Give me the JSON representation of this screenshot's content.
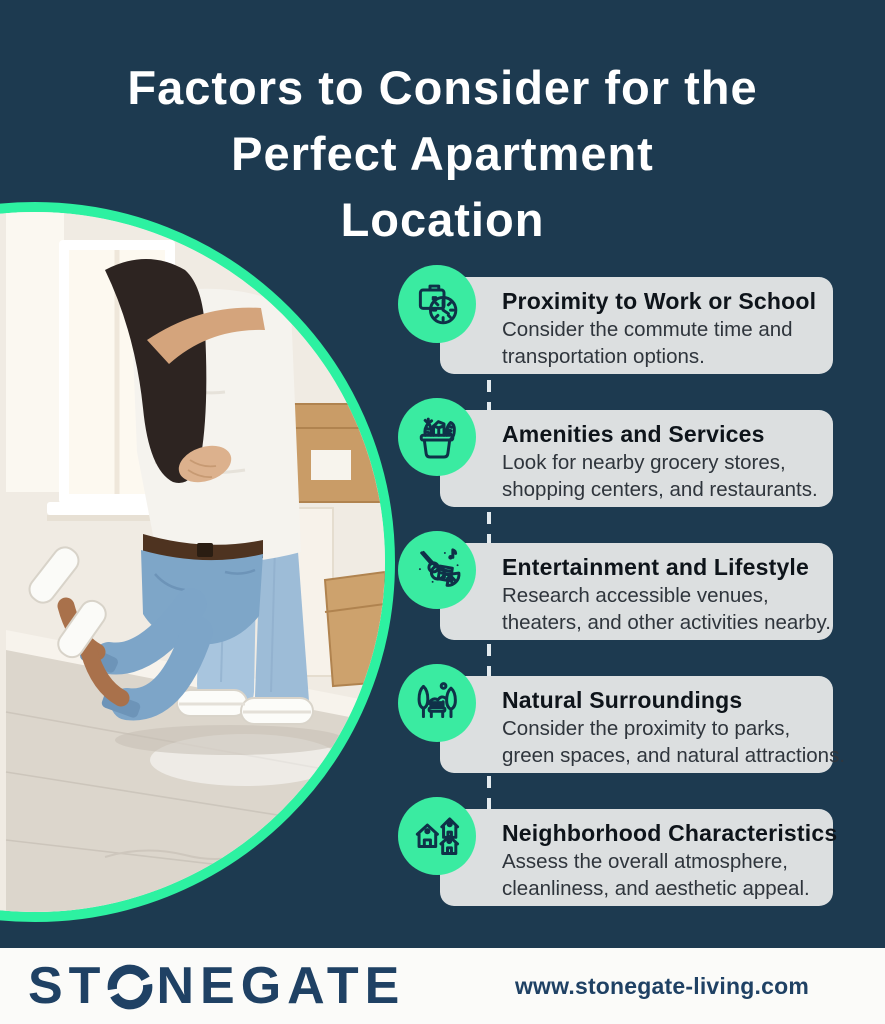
{
  "title": {
    "line1": "Factors to Consider for the",
    "line2": "Perfect Apartment",
    "line3": "Location"
  },
  "factors": [
    {
      "title": "Proximity to Work or School",
      "desc": [
        "Consider the commute time and",
        "transportation options."
      ],
      "icon": "briefcase-clock-icon"
    },
    {
      "title": "Amenities and Services",
      "desc": [
        "Look for nearby grocery stores,",
        "shopping centers, and restaurants."
      ],
      "icon": "grocery-basket-icon"
    },
    {
      "title": "Entertainment and Lifestyle",
      "desc": [
        "Research accessible venues,",
        "theaters, and other activities nearby."
      ],
      "icon": "music-entertainment-icon"
    },
    {
      "title": "Natural Surroundings",
      "desc": [
        "Consider the proximity to parks,",
        "green spaces, and natural attractions."
      ],
      "icon": "park-trees-bench-icon"
    },
    {
      "title": "Neighborhood Characteristics",
      "desc": [
        "Assess the overall atmosphere,",
        "cleanliness, and aesthetic appeal."
      ],
      "icon": "neighborhood-houses-icon"
    }
  ],
  "footer": {
    "brand_full": "STONEGATE",
    "brand_prefix": "ST",
    "brand_suffix": "NEGATE",
    "website": "www.stonegate-living.com"
  },
  "colors": {
    "background_navy": "#1d3a50",
    "accent_green": "#2df1a1",
    "icon_circle_green": "#3aeba1",
    "card_gray": "#dcdfe0",
    "footer_bg": "#fbfbf9",
    "logo_navy": "#1f4164"
  }
}
